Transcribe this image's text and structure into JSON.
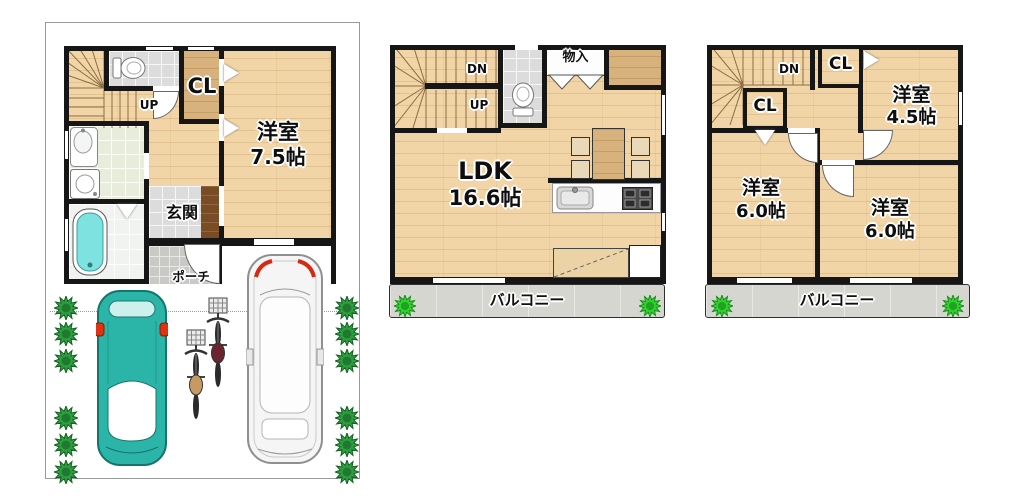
{
  "plans": {
    "f1": {
      "labels": {
        "up": "UP",
        "closet": "CL",
        "room": "洋室",
        "room_size": "7.5帖",
        "entrance": "玄関",
        "porch": "ポーチ"
      }
    },
    "f2": {
      "labels": {
        "down": "DN",
        "up": "UP",
        "storage": "物入",
        "ldk": "LDK",
        "ldk_size": "16.6帖",
        "balcony": "バルコニー"
      }
    },
    "f3": {
      "labels": {
        "down": "DN",
        "closet_a": "CL",
        "closet_b": "CL",
        "room_a": "洋室",
        "room_a_size": "4.5帖",
        "room_b": "洋室",
        "room_b_size": "6.0帖",
        "room_c": "洋室",
        "room_c_size": "6.0帖",
        "balcony": "バルコニー"
      }
    }
  },
  "colors": {
    "wall": "#161616",
    "wood_floor": "#f1d5a6",
    "wood_dark": "#d8b27c",
    "tile_gray": "#dcdcdc",
    "tile_green": "#e7edda",
    "balcony_gray": "#d6d6d0",
    "bathtub_teal": "#7de2e0",
    "car_teal": "#2bb5a8",
    "shrub_green": "#2f9e41",
    "shrub_bright": "#35cf35",
    "accent_red": "#d42a12",
    "cabinet_brown": "#7a4c24"
  }
}
